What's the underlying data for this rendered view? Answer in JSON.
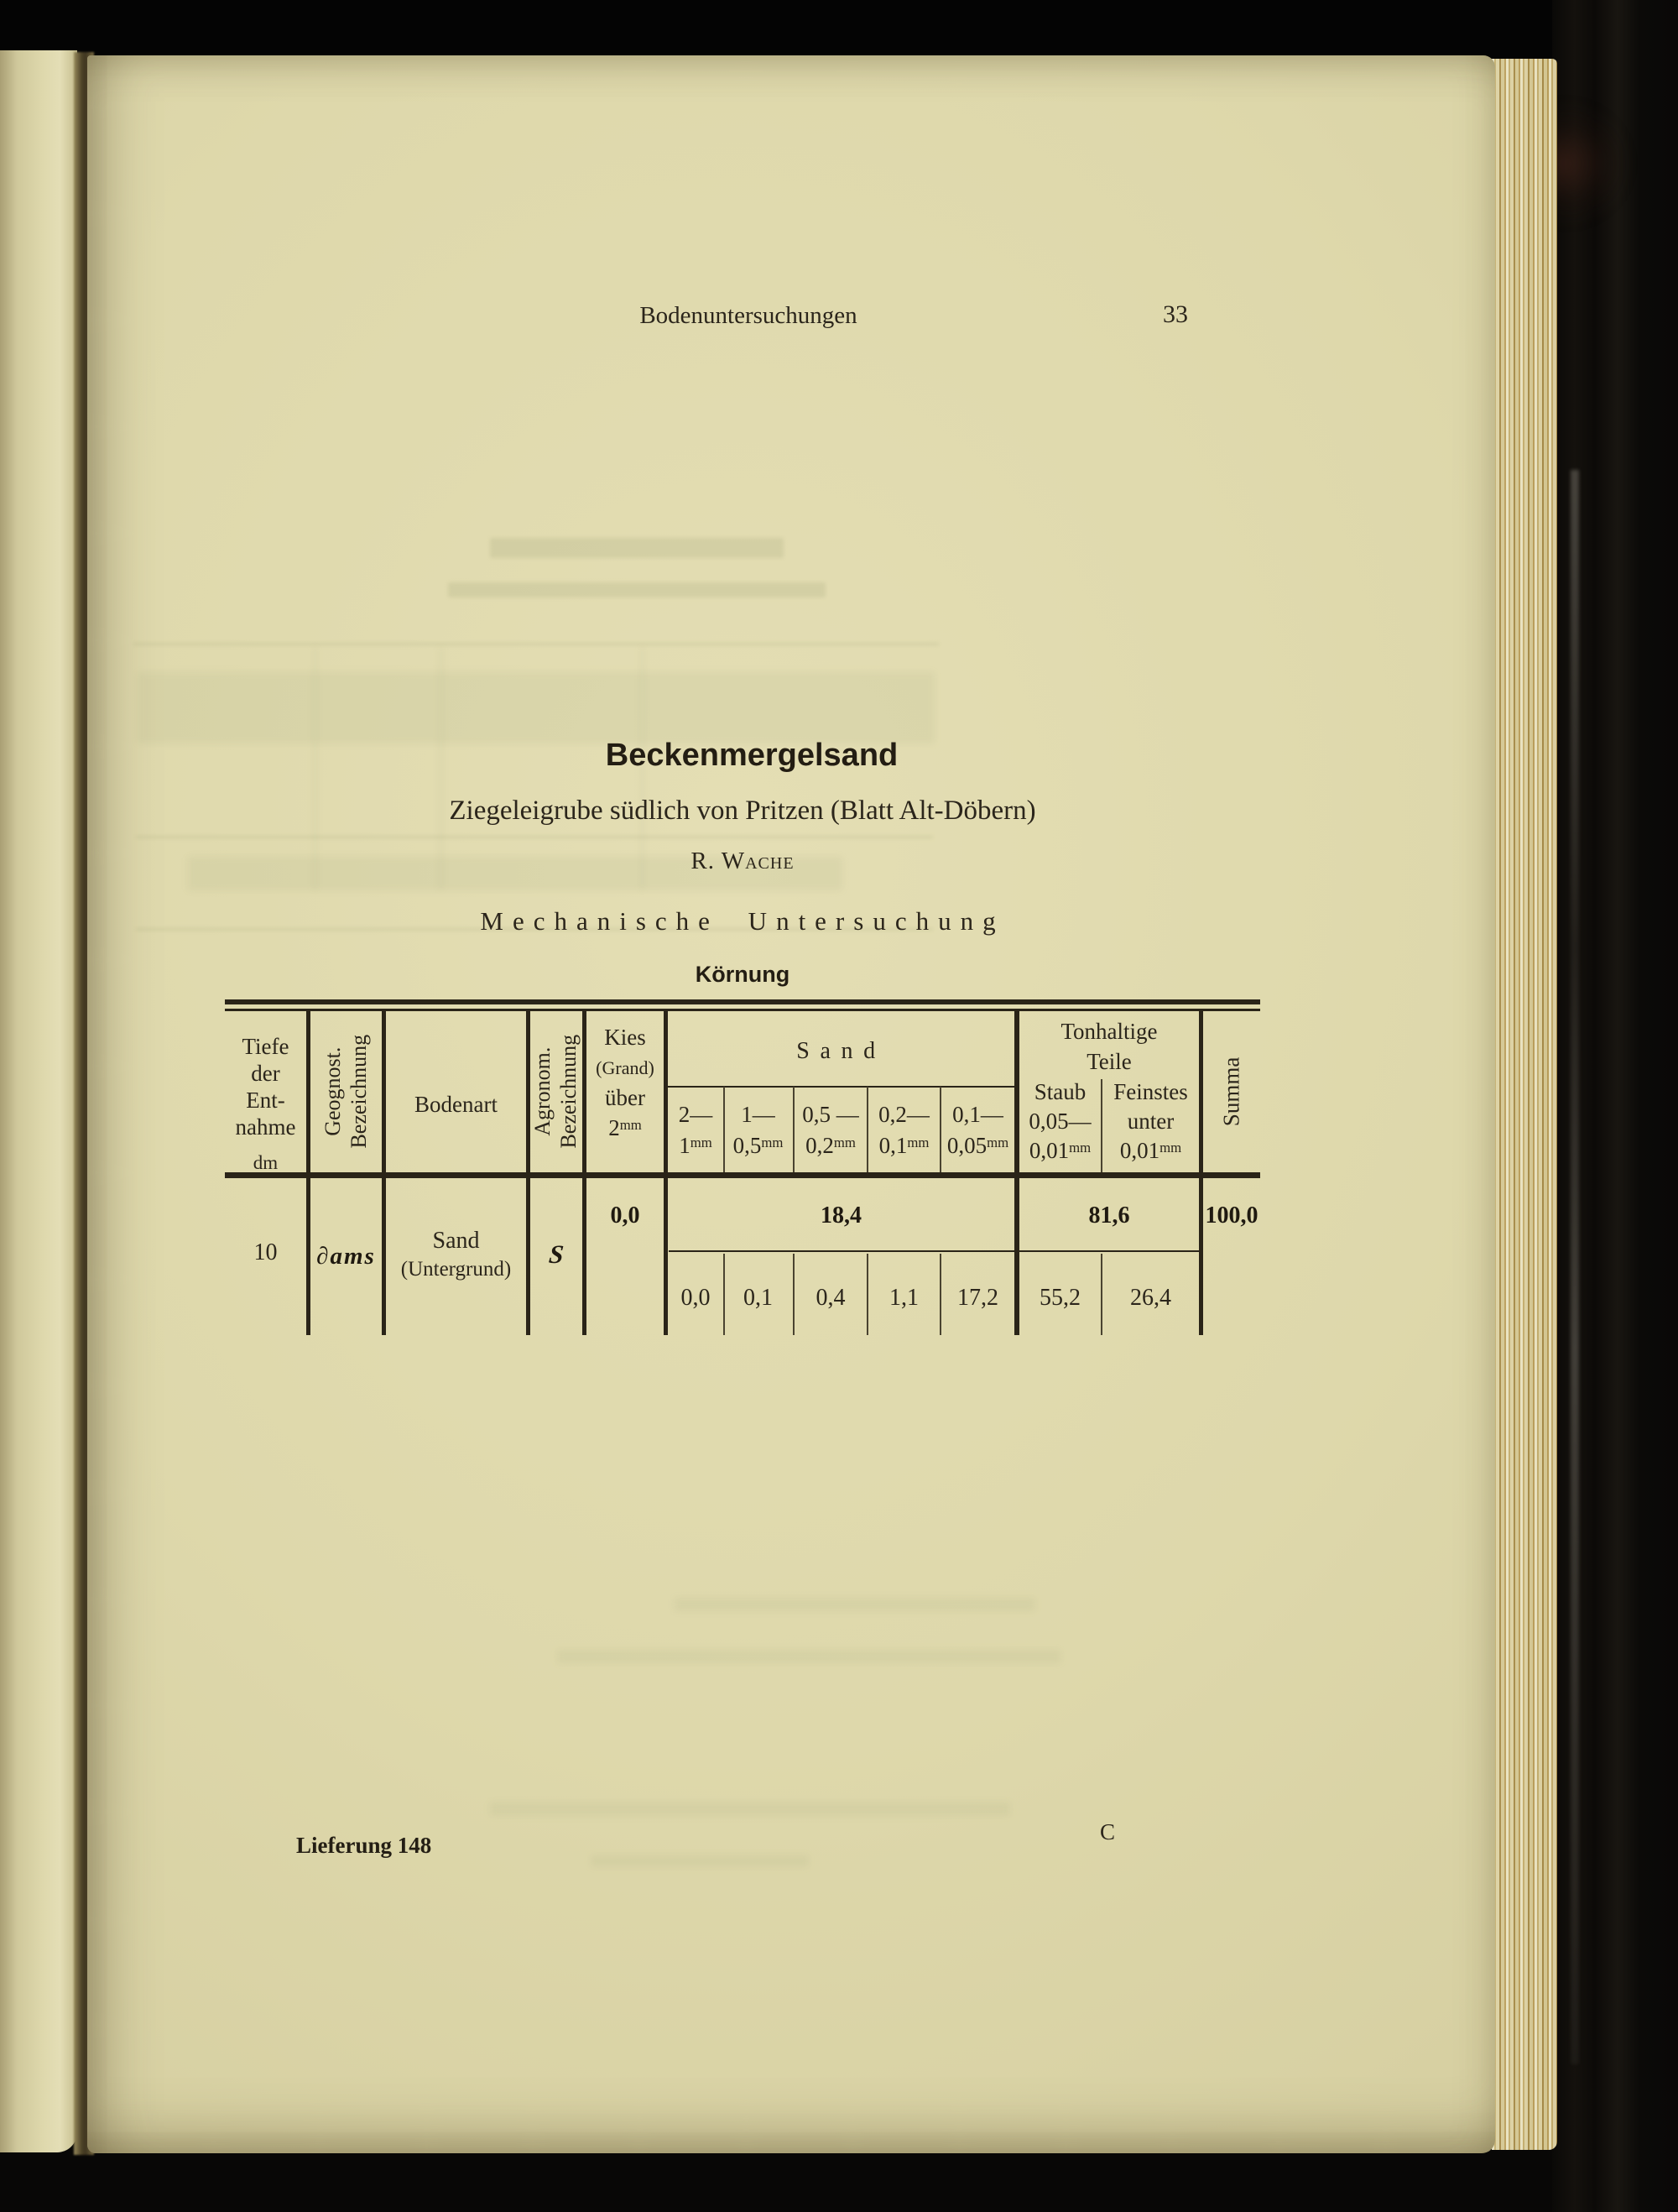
{
  "running_header": {
    "title": "Bodenuntersuchungen",
    "page_number": "33"
  },
  "heading": {
    "title": "Beckenmergelsand",
    "subtitle": "Ziegeleigrube südlich von Pritzen (Blatt Alt-Döbern)",
    "author": "R. Wache",
    "section": "Mechanische Untersuchung",
    "subsection": "Körnung"
  },
  "table": {
    "units": {
      "mm": "mm",
      "dm": "dm"
    },
    "header": {
      "depth_lines": [
        "Tiefe",
        "der",
        "Ent-",
        "nahme"
      ],
      "depth_unit": "dm",
      "geognost_l1": "Geognost.",
      "geognost_l2": "Bezeichnung",
      "bodenart": "Bodenart",
      "agronom_l1": "Agronom.",
      "agronom_l2": "Bezeichnung",
      "kies_lines": [
        "Kies",
        "(Grand)",
        "über"
      ],
      "kies_size": "2",
      "sand_group": "Sand",
      "sand_subs": [
        {
          "from": "2—",
          "to": "1"
        },
        {
          "from": "1—",
          "to": "0,5"
        },
        {
          "from": "0,5 —",
          "to": "0,2"
        },
        {
          "from": "0,2—",
          "to": "0,1"
        },
        {
          "from": "0,1—",
          "to": "0,05"
        }
      ],
      "ton_group_l1": "Tonhaltige",
      "ton_group_l2": "Teile",
      "staub_lines": [
        "Staub",
        "0,05—",
        "0,01"
      ],
      "feinstes_lines": [
        "Feinstes",
        "unter",
        "0,01"
      ],
      "summa": "Summa"
    },
    "row": {
      "depth": "10",
      "geognost": "∂ams",
      "bodenart": "Sand",
      "bodenart_note": "(Untergrund)",
      "agronom": "S",
      "kies": "0,0",
      "sand_total": "18,4",
      "sand_values": [
        "0,0",
        "0,1",
        "0,4",
        "1,1",
        "17,2"
      ],
      "ton_total": "81,6",
      "ton_values": [
        "55,2",
        "26,4"
      ],
      "summa": "100,0"
    }
  },
  "footer": {
    "edition": "Lieferung 148",
    "press_mark": "C"
  }
}
